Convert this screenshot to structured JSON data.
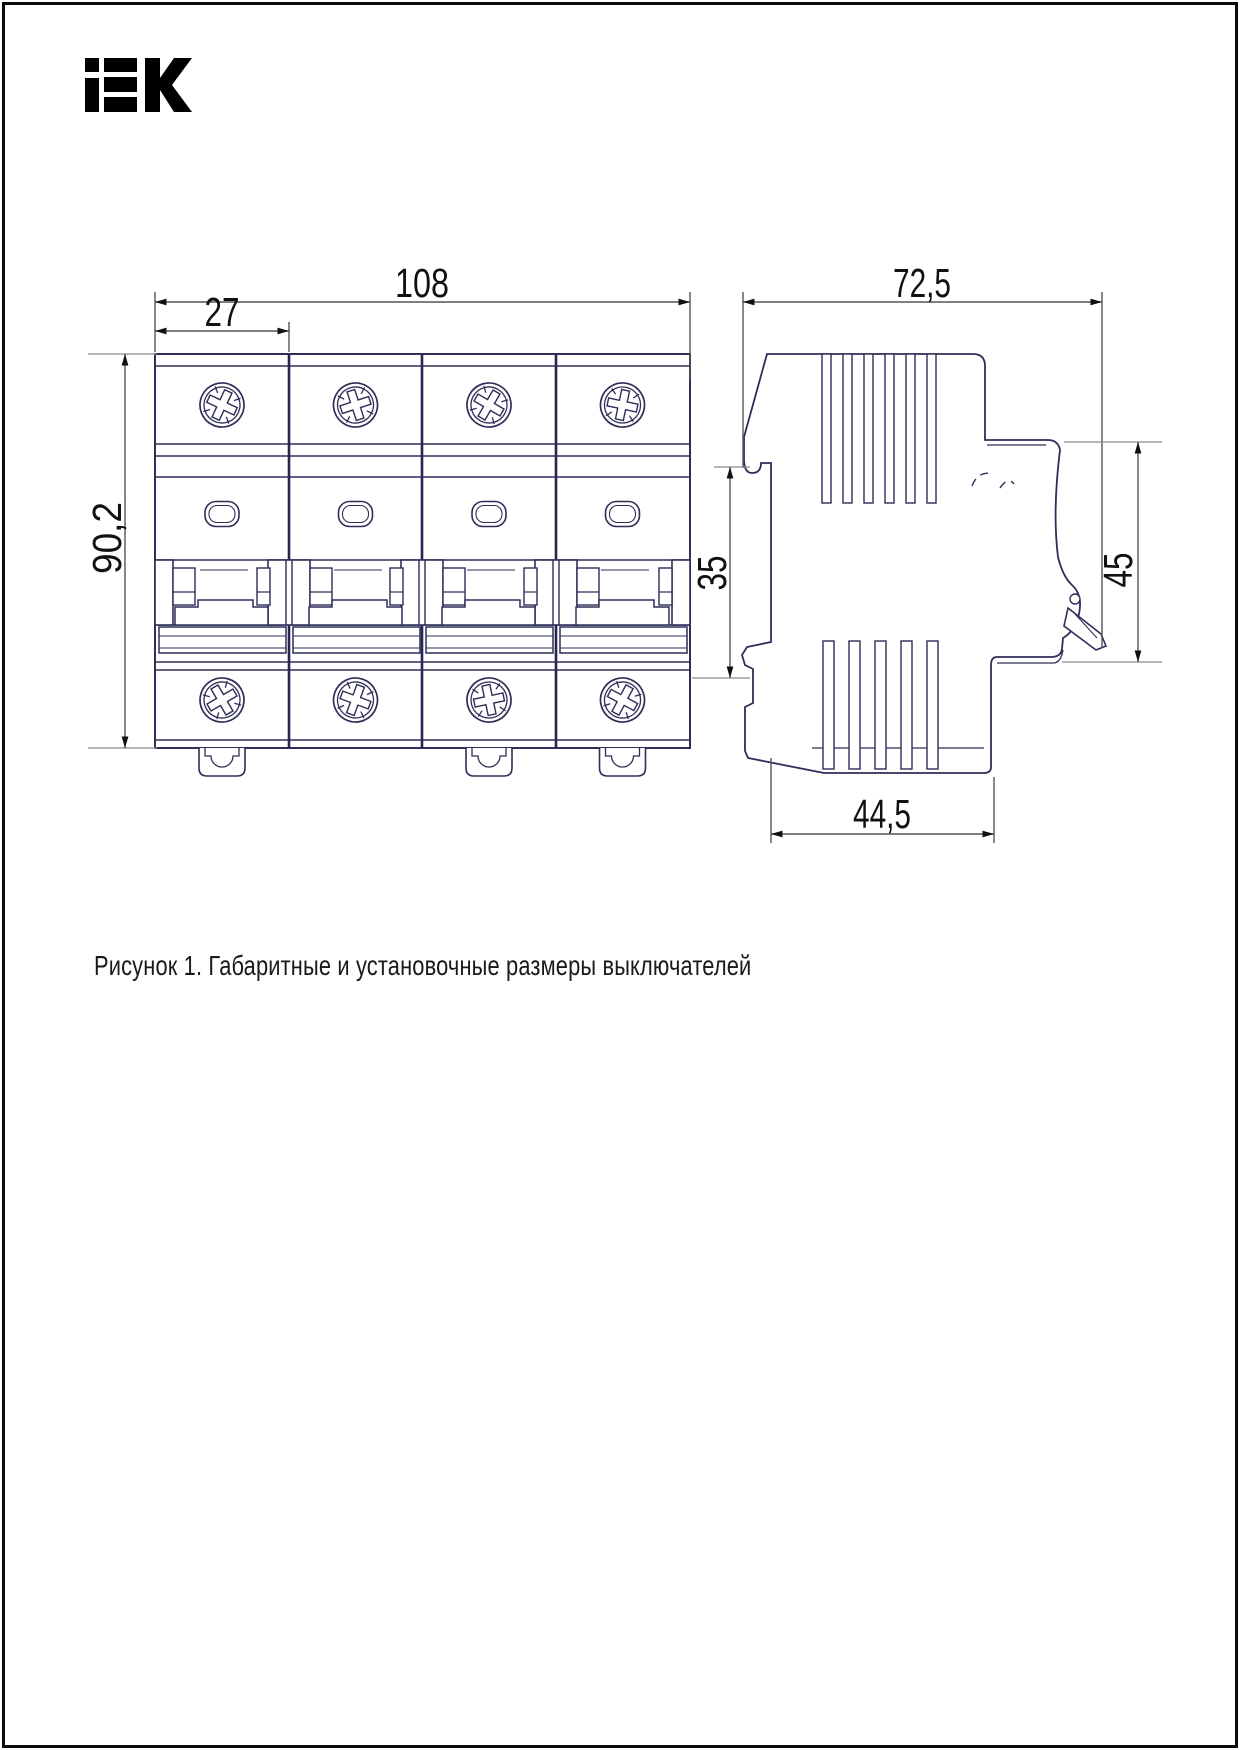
{
  "page": {
    "background": "#ffffff",
    "frame_color": "#0c0c0c"
  },
  "logo": {
    "label": "IEK",
    "color": "#000000"
  },
  "figure": {
    "caption": "Рисунок 1. Габаритные и установочные размеры выключателей",
    "front_view": {
      "overall_width": "108",
      "module_width": "27",
      "overall_height": "90,2",
      "modules": 4
    },
    "side_view": {
      "overall_depth": "72,5",
      "din_rail_zone": "35",
      "front_panel_height": "45",
      "base_depth": "44,5"
    },
    "colors": {
      "outline": "#2e2e58",
      "dimension_line": "#555555",
      "dimension_text": "#111111"
    }
  }
}
